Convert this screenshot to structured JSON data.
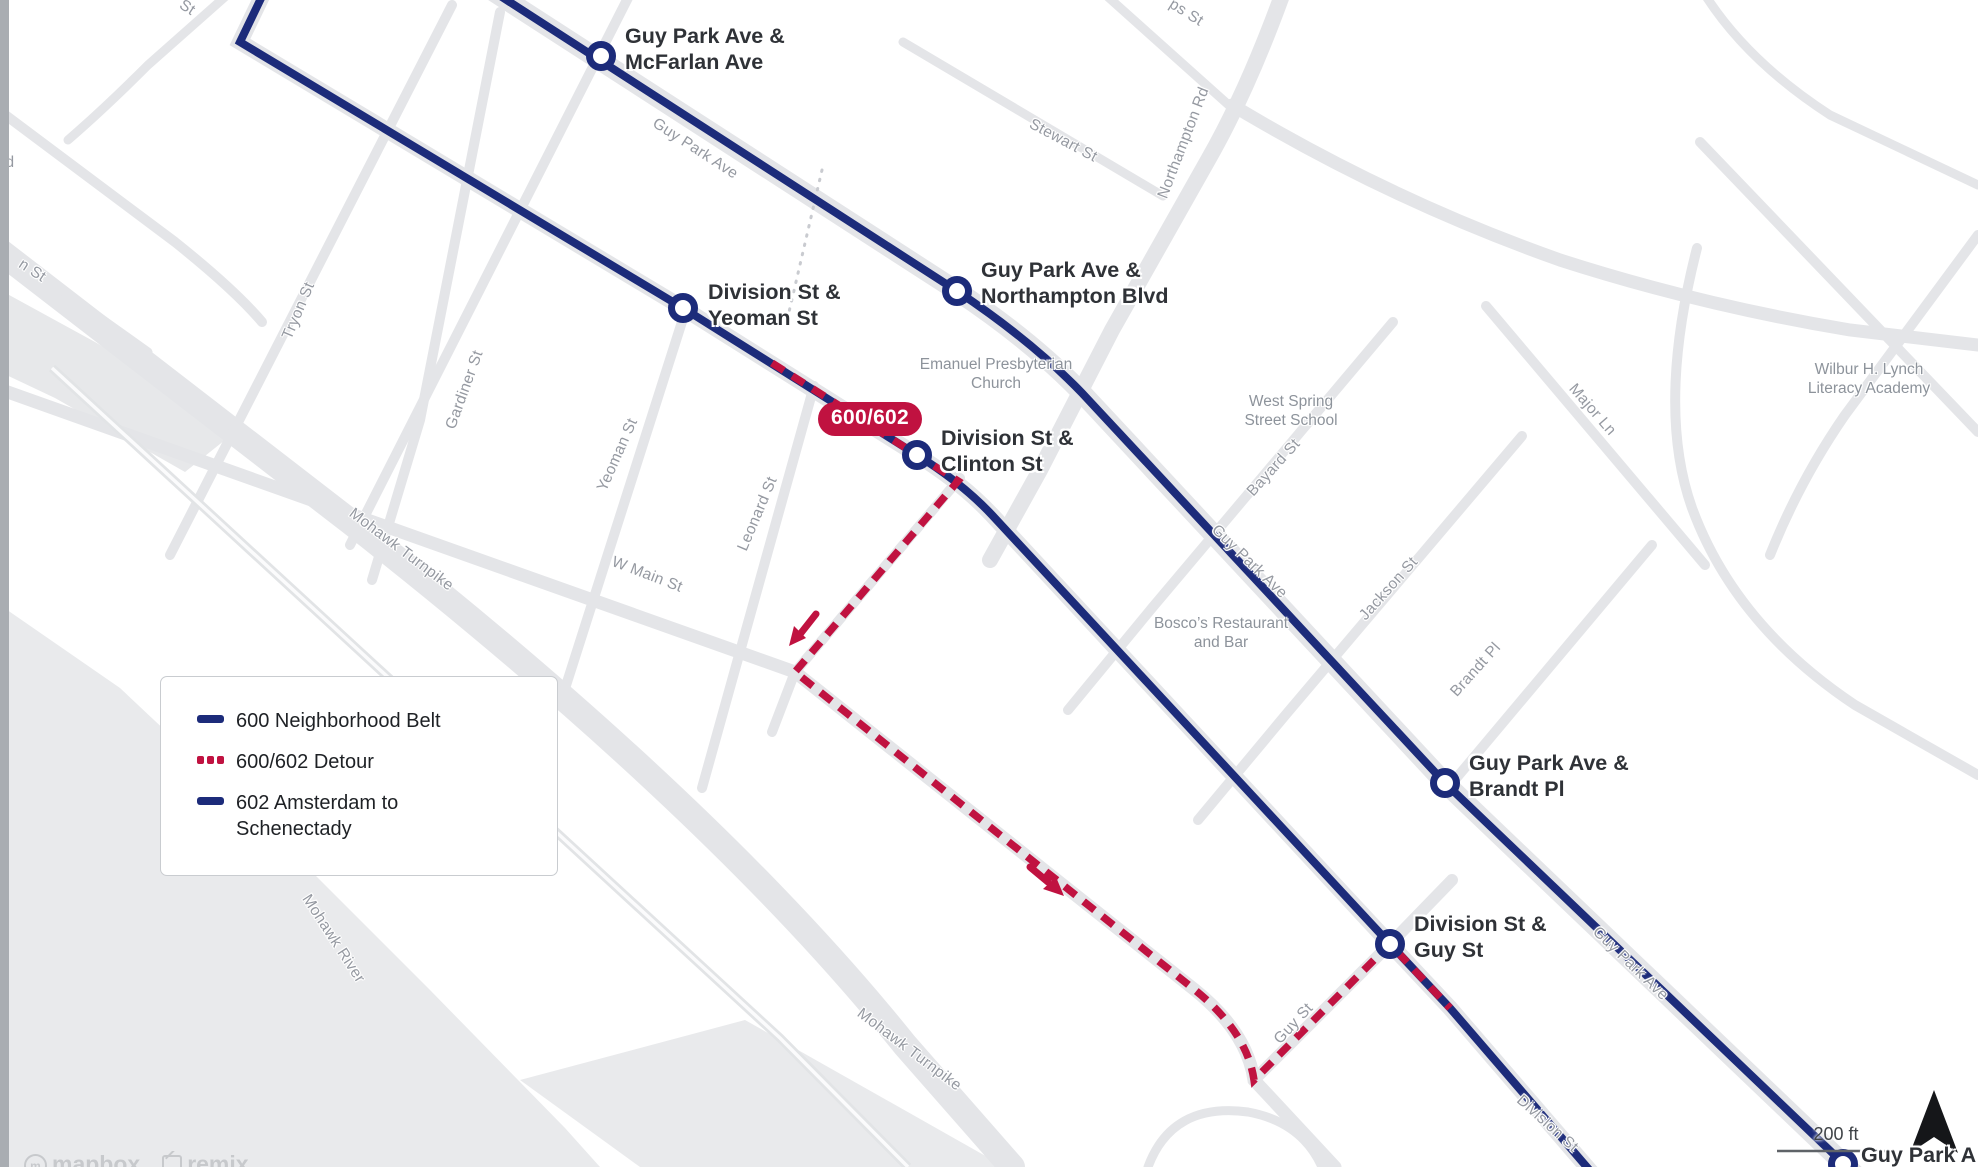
{
  "title": "Bus routes 600/602 detour map",
  "colors": {
    "route_navy": "#1c2b7a",
    "detour_red": "#c01240",
    "road_gray": "#e4e5e8",
    "water_gray": "#e9eaec",
    "street_label": "#9599a1",
    "poi_label": "#8d939b",
    "stop_label": "#2f3237"
  },
  "legend": {
    "items": [
      {
        "label": "600 Neighborhood Belt",
        "style": "solid-navy"
      },
      {
        "label": "600/602 Detour",
        "style": "dashed-red"
      },
      {
        "label": "602 Amsterdam to Schenectady",
        "style": "solid-navy"
      }
    ]
  },
  "badge": {
    "label": "600/602"
  },
  "stops": [
    {
      "line1": "Guy Park Ave &",
      "line2": "McFarlan Ave"
    },
    {
      "line1": "Division St &",
      "line2": "Yeoman St"
    },
    {
      "line1": "Guy Park Ave &",
      "line2": "Northampton Blvd"
    },
    {
      "line1": "Division St &",
      "line2": "Clinton St"
    },
    {
      "line1": "Guy Park Ave &",
      "line2": "Brandt Pl"
    },
    {
      "line1": "Division St &",
      "line2": "Guy St"
    },
    {
      "line1": "Guy Park A",
      "line2": ""
    }
  ],
  "streets": [
    "St",
    "ps St",
    "Stewart St",
    "Northampton Rd",
    "Guy Park Ave",
    "Tryon St",
    "d",
    "n St",
    "Gardiner St",
    "Yeoman St",
    "Leonard St",
    "W Main St",
    "Mohawk Turnpike",
    "Mohawk River",
    "Mohawk Turnpike",
    "Bayard St",
    "Jackson St",
    "Major Ln",
    "Brandt Pl",
    "Guy Park Ave",
    "Guy St",
    "Guy Park Ave",
    "Division St"
  ],
  "pois": [
    {
      "line1": "Emanuel Presbyterian",
      "line2": "Church"
    },
    {
      "line1": "West Spring",
      "line2": "Street School"
    },
    {
      "line1": "Bosco’s Restaurant",
      "line2": "and Bar"
    },
    {
      "line1": "Wilbur H. Lynch",
      "line2": "Literacy Academy"
    }
  ],
  "scale_bar": {
    "label": "200 ft"
  },
  "attribution": {
    "mapbox": "mapbox",
    "remix": "remix"
  }
}
